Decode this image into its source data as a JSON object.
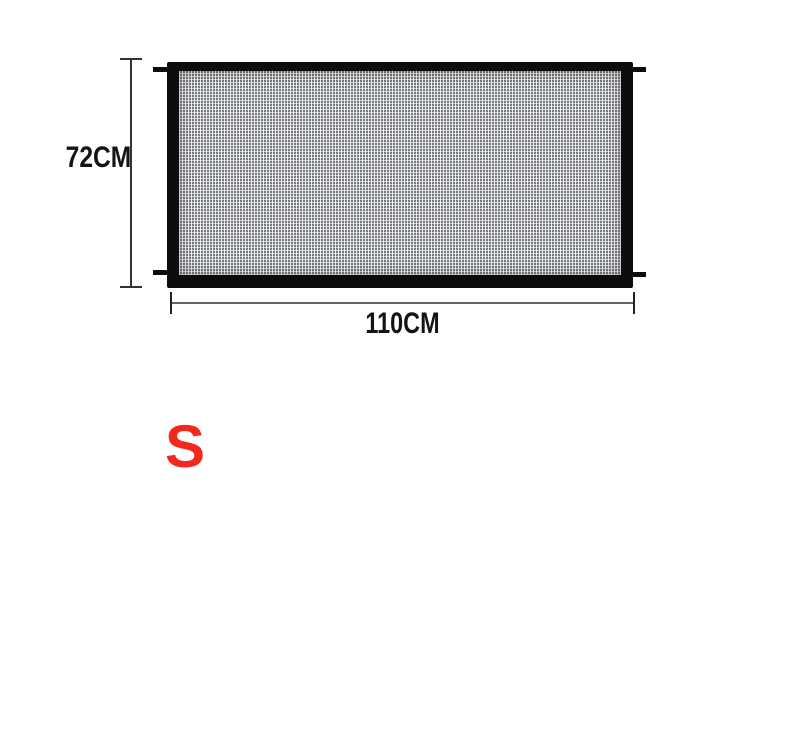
{
  "diagram": {
    "product": "mesh-safety-gate",
    "height_label": "72CM",
    "width_label": "110CM",
    "size_label": "S"
  },
  "theme": {
    "frame-black": "#0c0c0c",
    "mesh-base": "#9ea2a7",
    "dim-dark": "#333333",
    "dim-gray": "#666666",
    "tick-dark": "#222222",
    "accent-red": "#f2281e",
    "bg": "#ffffff"
  }
}
